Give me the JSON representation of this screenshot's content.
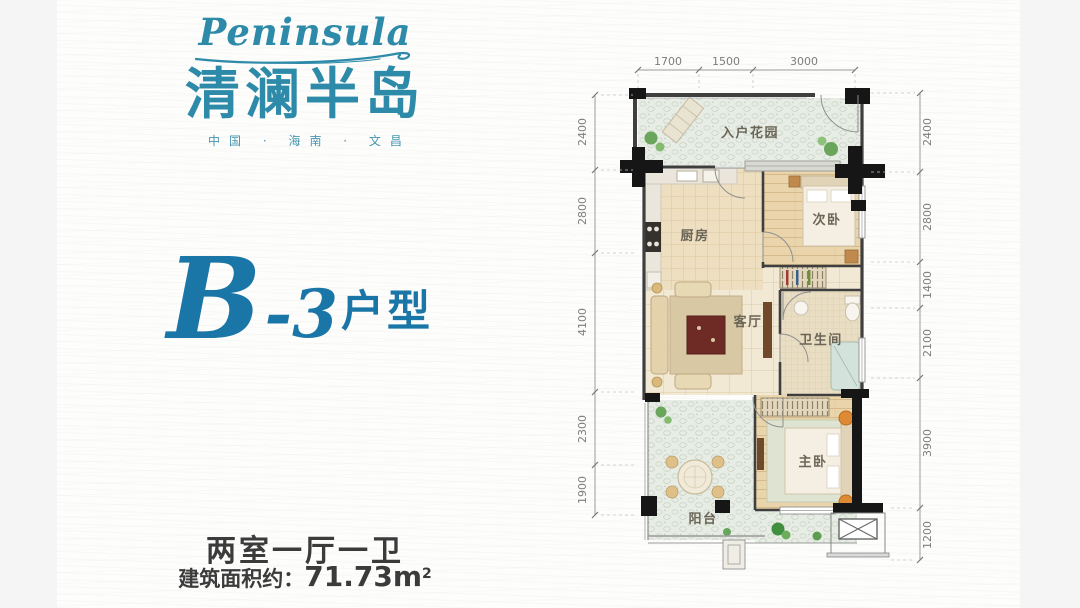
{
  "brand": {
    "script": "Peninsula",
    "name_cn": "清澜半岛",
    "tagline": "中国 · 海南 · 文昌"
  },
  "unit": {
    "code_letter": "B",
    "code_rest": "-3",
    "suffix": "户型"
  },
  "footer": {
    "layout_summary": "两室一厅一卫",
    "area_label": "建筑面积约：",
    "area_value": "71.73m",
    "area_sup": "2"
  },
  "plan": {
    "rooms": [
      {
        "id": "entry-garden",
        "label": "入户花园"
      },
      {
        "id": "kitchen",
        "label": "厨房"
      },
      {
        "id": "second-bedroom",
        "label": "次卧"
      },
      {
        "id": "living-room",
        "label": "客厅"
      },
      {
        "id": "bathroom",
        "label": "卫生间"
      },
      {
        "id": "master-bedroom",
        "label": "主卧"
      },
      {
        "id": "balcony",
        "label": "阳台"
      }
    ],
    "dimensions": {
      "top": [
        "1700",
        "1500",
        "3000"
      ],
      "left": [
        "2400",
        "2800",
        "4100",
        "2300",
        "1900"
      ],
      "right": [
        "2400",
        "2800",
        "1400",
        "2100",
        "3900",
        "1200"
      ]
    }
  },
  "colors": {
    "brand_teal": "#2d8aa8",
    "unit_blue": "#1b76a8",
    "text_dark": "#3b3b3b",
    "dim_gray": "#7d7d7d"
  }
}
